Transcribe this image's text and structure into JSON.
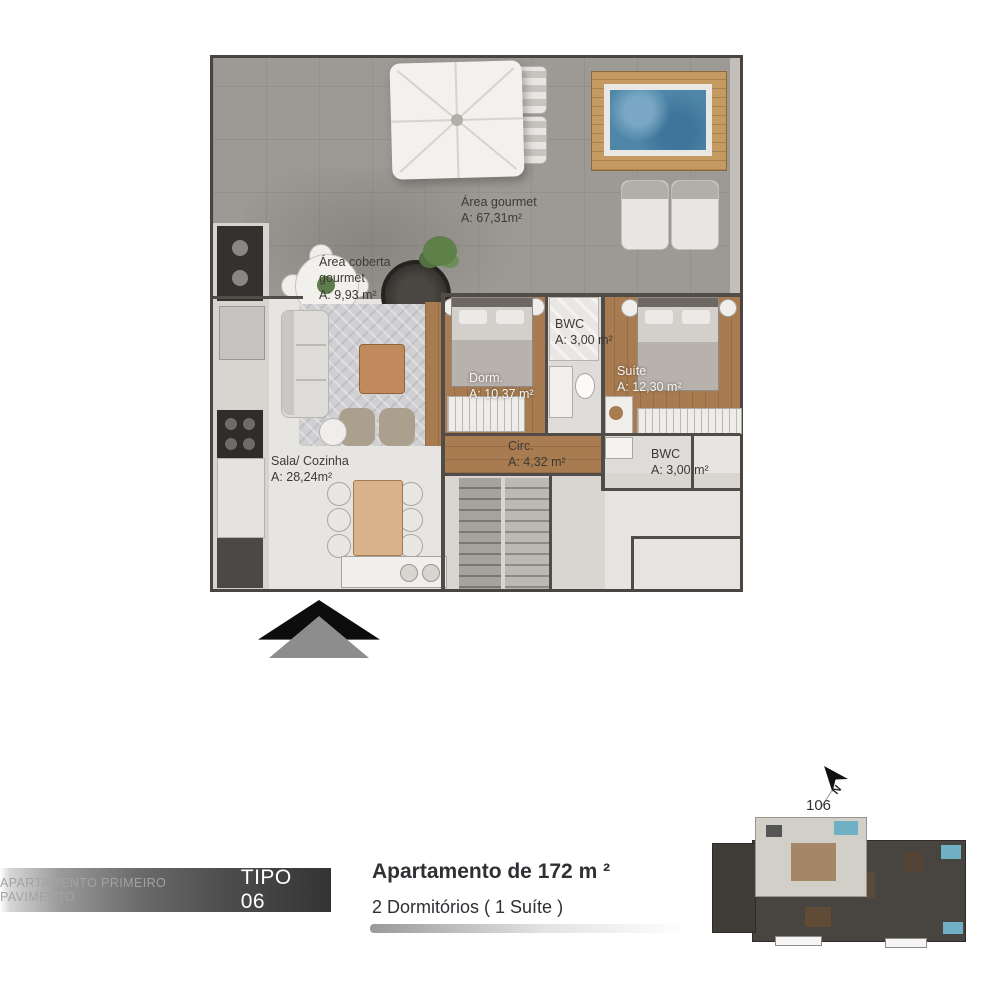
{
  "plan": {
    "labels": {
      "area_gourmet": {
        "name": "Área gourmet",
        "area": "A: 67,31m²"
      },
      "area_coberta": {
        "name": "Área coberta gourmet",
        "area": "A: 9,93 m²"
      },
      "bwc_1": {
        "name": "BWC",
        "area": "A: 3,00 m²"
      },
      "dorm": {
        "name": "Dorm.",
        "area": "A: 10,37 m²"
      },
      "suite": {
        "name": "Suíte",
        "area": "A: 12,30 m²"
      },
      "circ": {
        "name": "Circ.",
        "area": "A: 4,32 m²"
      },
      "bwc_2": {
        "name": "BWC",
        "area": "A: 3,00 m²"
      },
      "sala": {
        "name": "Sala/ Cozinha",
        "area": "A: 28,24m²"
      }
    }
  },
  "footer": {
    "bar": {
      "muted": "APARTAMENTO PRIMEIRO PAVIMENTO",
      "strong": "TIPO 06"
    },
    "line1": "Apartamento de 172 m ²",
    "line2": "2 Dormitórios ( 1 Suíte )"
  },
  "minimap": {
    "unit": "106",
    "north": "N"
  },
  "colors": {
    "deck": "#9d9995",
    "interior_floor": "#e7e5e1",
    "wood_floor": "#a87c50",
    "spa_water": "#4e86a8",
    "wall": "#514c48",
    "bar_dark": "#343434",
    "minimap_highlight": "#d2cfc9",
    "minimap_pool": "#6fb0c4"
  }
}
